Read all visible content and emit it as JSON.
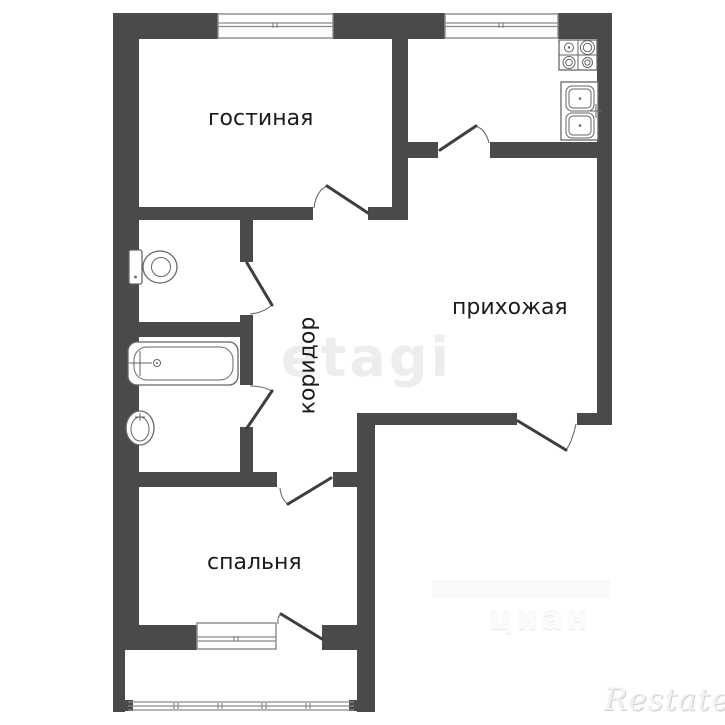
{
  "plan": {
    "type": "apartment-floor-plan",
    "rooms": {
      "living": {
        "label": "гостиная"
      },
      "hallway": {
        "label": "прихожая"
      },
      "corridor": {
        "label": "коридор"
      },
      "bedroom": {
        "label": "спальня"
      }
    },
    "fixtures": [
      "toilet",
      "bathtub",
      "wash-basin",
      "stove-4-burner",
      "kitchen-double-sink"
    ],
    "features": [
      "living-room-window",
      "kitchen-window",
      "bedroom-window",
      "balcony-glazing",
      "living-room-door",
      "kitchen-door",
      "wc-door",
      "bathroom-door",
      "bedroom-door",
      "balcony-door",
      "entrance-door"
    ]
  },
  "watermarks": {
    "brand_center": "etagi",
    "brand_right": "циан",
    "brand_corner": "Restate"
  },
  "colors": {
    "wall": "#4a4a4a",
    "label": "#1c1c1c",
    "watermark": "#ededed",
    "background": "#ffffff"
  }
}
